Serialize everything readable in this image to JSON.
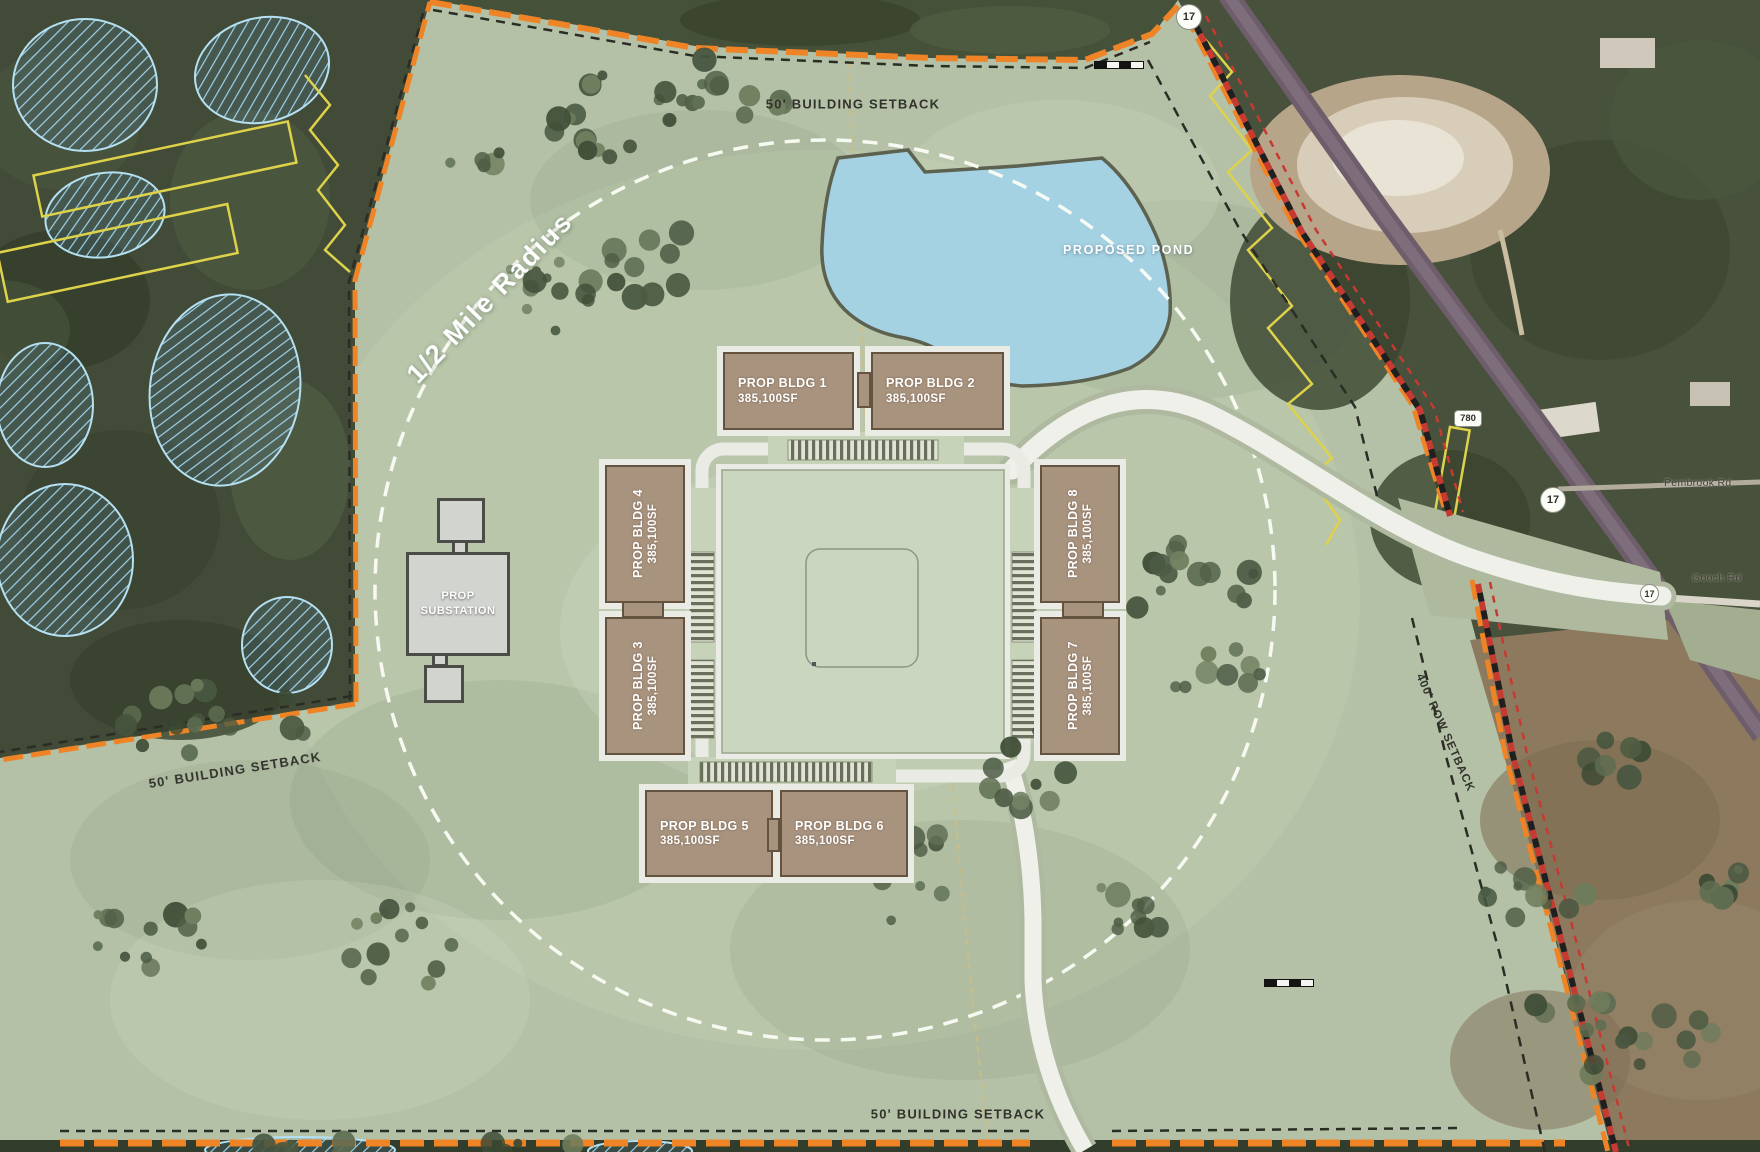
{
  "plan": {
    "radius_label": "1/2 Mile Radius",
    "pond_label": "PROPOSED POND",
    "substation": {
      "line1": "PROP",
      "line2": "SUBSTATION"
    },
    "setbacks": {
      "top": "50' BUILDING SETBACK",
      "left": "50' BUILDING SETBACK",
      "bottom": "50' BUILDING SETBACK",
      "row": "400' ROW SETBACK"
    },
    "buildings": [
      {
        "name": "PROP BLDG 1",
        "area": "385,100SF"
      },
      {
        "name": "PROP BLDG 2",
        "area": "385,100SF"
      },
      {
        "name": "PROP BLDG 3",
        "area": "385,100SF"
      },
      {
        "name": "PROP BLDG 4",
        "area": "385,100SF"
      },
      {
        "name": "PROP BLDG 5",
        "area": "385,100SF"
      },
      {
        "name": "PROP BLDG 6",
        "area": "385,100SF"
      },
      {
        "name": "PROP BLDG 7",
        "area": "385,100SF"
      },
      {
        "name": "PROP BLDG 8",
        "area": "385,100SF"
      }
    ],
    "roads": {
      "route_17_top": "17",
      "route_17_mid": "17",
      "route_17_junction": "17",
      "route_780": "780",
      "pembrook": "Pembrook Rd",
      "gooch": "Gooch Rd"
    },
    "colors": {
      "boundary_orange": "#ef8427",
      "pond_blue": "#a5d2e3",
      "building_tan": "#a8937f",
      "site_green": "#b4c1a6"
    }
  }
}
